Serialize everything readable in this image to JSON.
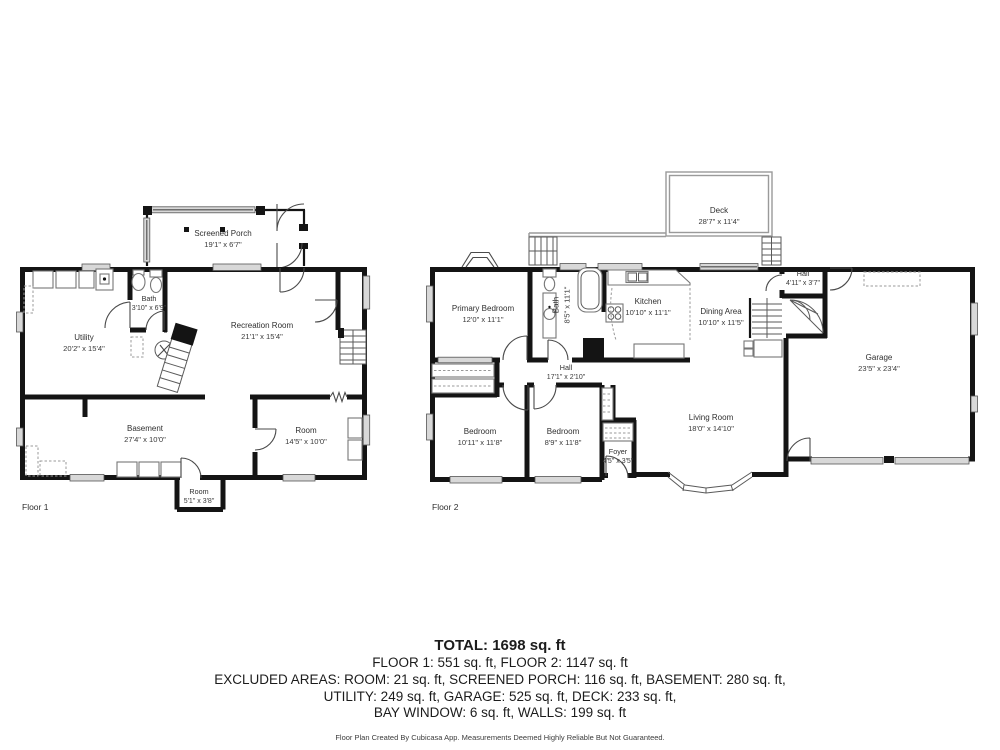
{
  "floor1": {
    "tag": "Floor 1",
    "rooms": {
      "screened_porch": {
        "name": "Screened Porch",
        "dims": "19'1\" x 6'7\""
      },
      "bath": {
        "name": "Bath",
        "dims": "3'10\" x 6'9\""
      },
      "utility": {
        "name": "Utility",
        "dims": "20'2\" x 15'4\""
      },
      "recreation": {
        "name": "Recreation Room",
        "dims": "21'1\" x 15'4\""
      },
      "basement": {
        "name": "Basement",
        "dims": "27'4\" x 10'0\""
      },
      "room": {
        "name": "Room",
        "dims": "14'5\" x 10'0\""
      },
      "room_small": {
        "name": "Room",
        "dims": "5'1\" x 3'8\""
      }
    }
  },
  "floor2": {
    "tag": "Floor 2",
    "rooms": {
      "deck": {
        "name": "Deck",
        "dims": "28'7\" x 11'4\""
      },
      "primary_bedroom": {
        "name": "Primary Bedroom",
        "dims": "12'0\" x 11'1\""
      },
      "bath": {
        "name": "Bath",
        "dims": "8'5\" x 11'1\""
      },
      "kitchen": {
        "name": "Kitchen",
        "dims": "10'10\" x 11'1\""
      },
      "dining": {
        "name": "Dining Area",
        "dims": "10'10\" x 11'5\""
      },
      "hall_small": {
        "name": "Hall",
        "dims": "4'11\" x 3'7\""
      },
      "hall": {
        "name": "Hall",
        "dims": "17'1\" x 2'10\""
      },
      "garage": {
        "name": "Garage",
        "dims": "23'5\" x 23'4\""
      },
      "bedroom1": {
        "name": "Bedroom",
        "dims": "10'11\" x 11'8\""
      },
      "bedroom2": {
        "name": "Bedroom",
        "dims": "8'9\" x 11'8\""
      },
      "foyer": {
        "name": "Foyer",
        "dims": "4'5\" x 3'5\""
      },
      "living": {
        "name": "Living Room",
        "dims": "18'0\" x 14'10\""
      }
    }
  },
  "summary": {
    "total": "TOTAL: 1698 sq. ft",
    "line1": "FLOOR 1: 551 sq. ft, FLOOR 2: 1147 sq. ft",
    "line2": "EXCLUDED AREAS: ROOM: 21 sq. ft, SCREENED PORCH: 116 sq. ft, BASEMENT: 280 sq. ft,",
    "line3": "UTILITY: 249 sq. ft, GARAGE: 525 sq. ft, DECK: 233 sq. ft,",
    "line4": "BAY WINDOW: 6 sq. ft, WALLS: 199 sq. ft",
    "disclaimer": "Floor Plan Created By Cubicasa App. Measurements Deemed Highly Reliable But Not Guaranteed."
  },
  "colors": {
    "wall": "#141414",
    "text": "#2d2d2d",
    "window_band": "#d8d8d8",
    "fixture": "#777777"
  }
}
